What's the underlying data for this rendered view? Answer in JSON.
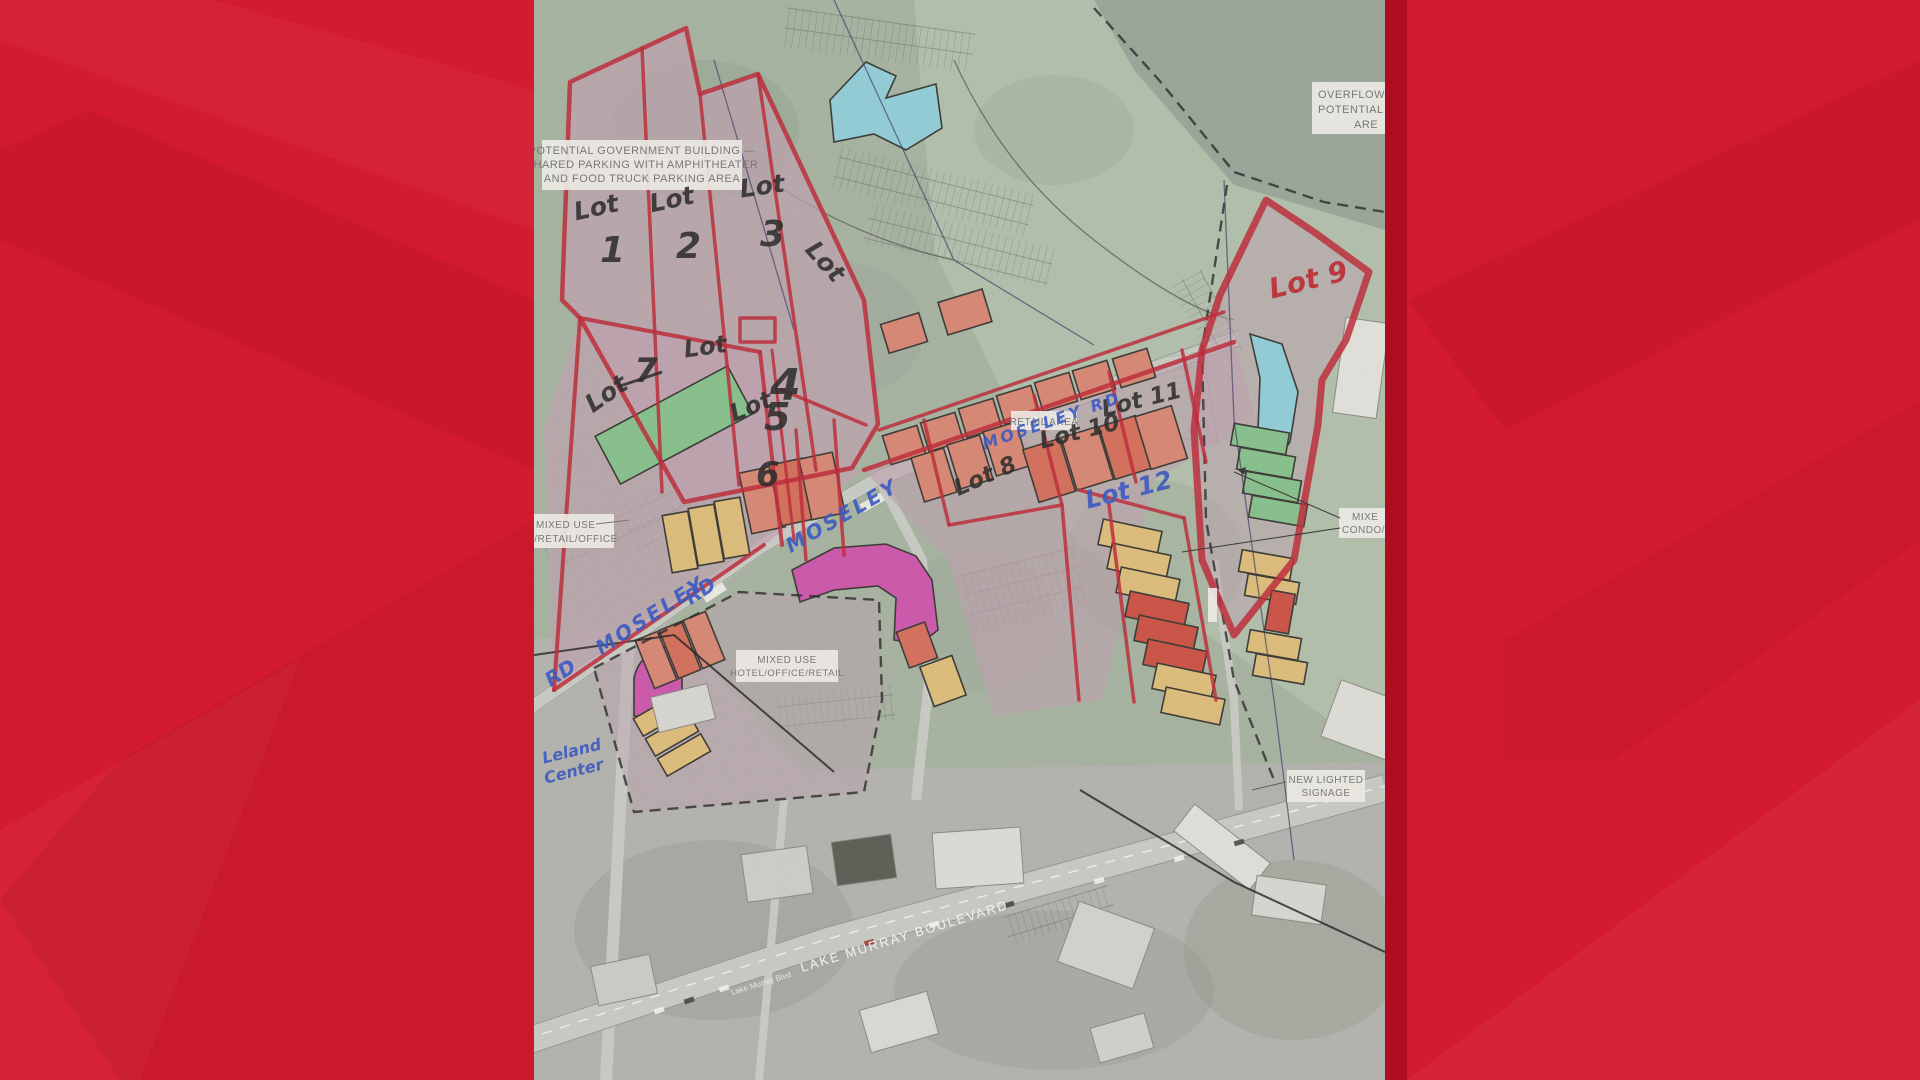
{
  "scene": "news-graphic-development-site-plan-photo",
  "palette": {
    "background_red": "#d41a2e",
    "background_red_dark": "#ad0d1f",
    "aerial_green": "#a7b5a2",
    "aerial_gray": "#b5b5b1",
    "parcel_mauve": "#c2a2b2",
    "building_salmon": "#dd8570",
    "building_yellow": "#e3c078",
    "building_green": "#83c48b",
    "building_cyan": "#8fd2de",
    "building_magenta": "#d14fae",
    "marker_red": "#c01d2e",
    "ink_blue": "#2b4fc8",
    "ink_black": "#1d1d1d"
  },
  "labels": {
    "gov1": "POTENTIAL GOVERNMENT BUILDING —",
    "gov2": "SHARED PARKING WITH AMPHITHEATER",
    "gov3": "AND FOOD TRUCK PARKING AREA",
    "over1": "OVERFLOW PA",
    "over2": "POTENTIAL VE",
    "over3": "ARE",
    "retail": "RETAIL AREA",
    "mixed_left1": "MIXED USE",
    "mixed_left2": "O/RETAIL/OFFICE",
    "hotel1": "MIXED USE",
    "hotel2": "HOTEL/OFFICE/RETAIL",
    "mixed_right1": "MIXE",
    "mixed_right2": "CONDO/RE",
    "sign1": "NEW LIGHTED",
    "sign2": "SIGNAGE",
    "blvd": "LAKE MURRAY BOULEVARD",
    "blvd_small": "Lake Murray Blvd"
  },
  "handwriting": {
    "lot_word": "Lot",
    "lot1": "1",
    "lot2": "2",
    "lot3": "3",
    "lot4": "4",
    "lot5": "5",
    "lot6": "6",
    "lot7": "7",
    "lot8": "Lot 8",
    "lot9": "Lot 9",
    "lot10": "Lot 10",
    "lot11": "Lot 11",
    "lot12": "Lot 12",
    "moseley": "MOSELEY",
    "rd": "RD",
    "moseley_rd": "MOSELEY RD",
    "center1": "Leland",
    "center2": "Center"
  }
}
